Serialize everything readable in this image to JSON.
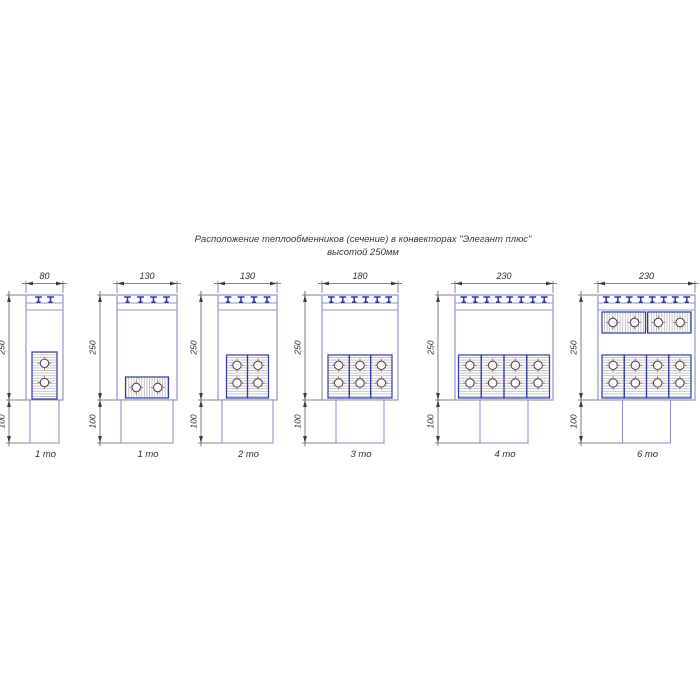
{
  "title": {
    "line1": "Расположение теплообменников (сечение) в конвекторах \"Элегант плюс\"",
    "line2": "высотой 250мм"
  },
  "units": [
    {
      "width_label": "80",
      "height_label": "250",
      "duct_label": "100",
      "caption": "1 то",
      "grille_teeth": 2,
      "exchangers_vertical": 1,
      "exchangers_horizontal": 0,
      "tubes": 2
    },
    {
      "width_label": "130",
      "height_label": "250",
      "duct_label": "100",
      "caption": "1 то",
      "grille_teeth": 4,
      "exchangers_vertical": 0,
      "exchangers_horizontal": 1,
      "tubes": 2
    },
    {
      "width_label": "130",
      "height_label": "250",
      "duct_label": "100",
      "caption": "2 то",
      "grille_teeth": 4,
      "exchangers_vertical": 2,
      "exchangers_horizontal": 0,
      "tubes": 4
    },
    {
      "width_label": "180",
      "height_label": "250",
      "duct_label": "100",
      "caption": "3 то",
      "grille_teeth": 6,
      "exchangers_vertical": 3,
      "exchangers_horizontal": 0,
      "tubes": 6
    },
    {
      "width_label": "230",
      "height_label": "250",
      "duct_label": "100",
      "caption": "4 то",
      "grille_teeth": 8,
      "exchangers_vertical": 4,
      "exchangers_horizontal": 0,
      "tubes": 8
    },
    {
      "width_label": "230",
      "height_label": "250",
      "duct_label": "100",
      "caption": "6 то",
      "grille_teeth": 8,
      "exchangers_vertical": 4,
      "exchangers_horizontal": 2,
      "tubes": 12
    }
  ],
  "colors": {
    "casing": "#8e96c8",
    "profile": "#2e3aa0",
    "hatch": "#b2b2ba",
    "tube_outline": "#3c3c5e",
    "tube_cross": "#c2763a",
    "dimension_line": "#5a5a64",
    "text": "#2e2e36",
    "title_text": "#333a33"
  }
}
